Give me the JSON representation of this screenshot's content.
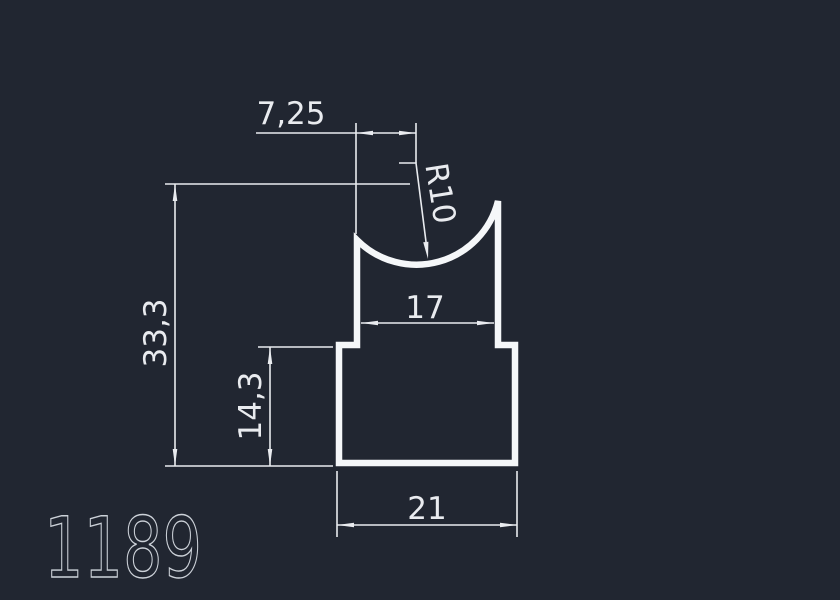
{
  "background": "#212631",
  "line_color": "#e9ebef",
  "profile_color": "#f5f7f9",
  "part_label_color": "#ccd1d8",
  "drawing": {
    "part_number": "1189",
    "dimensions": {
      "offset_top": "7,25",
      "radius": "R10",
      "total_height": "33,3",
      "inner_width": "17",
      "base_height": "14,3",
      "base_width": "21"
    }
  }
}
